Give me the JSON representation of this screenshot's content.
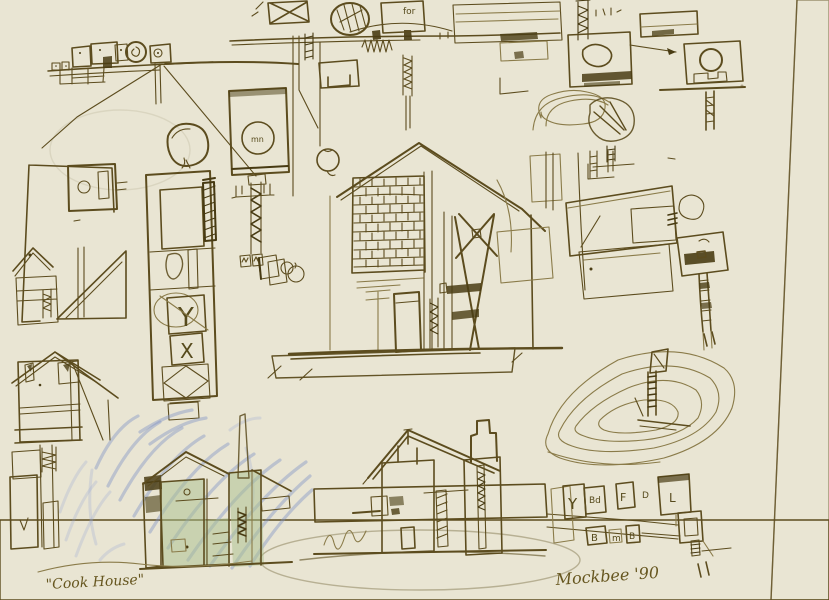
{
  "photo": {
    "description": "Photograph of a hand-drawn ink concept sketch page with house studies, plans and elevations, partly shaded with blue and green pencil",
    "colors": {
      "paper": "#e9e5d3",
      "paper_shadow": "#ddd7c2",
      "ink": "#5c4c1e",
      "ink_dark": "#473a12",
      "pencil_blue": "#7e91c5",
      "wash_green": "#a9bf8e"
    }
  },
  "annotations": {
    "title": "\"Cook House\"",
    "signature": "Mockbee '90",
    "plan_note": "for",
    "circle_note": "mn"
  },
  "room_boxes": {
    "row1": [
      "Y",
      "Bd",
      "F",
      "D",
      "L"
    ],
    "row2": [
      "B",
      "m",
      "B"
    ]
  },
  "strip_letters": [
    "Y",
    "X"
  ]
}
